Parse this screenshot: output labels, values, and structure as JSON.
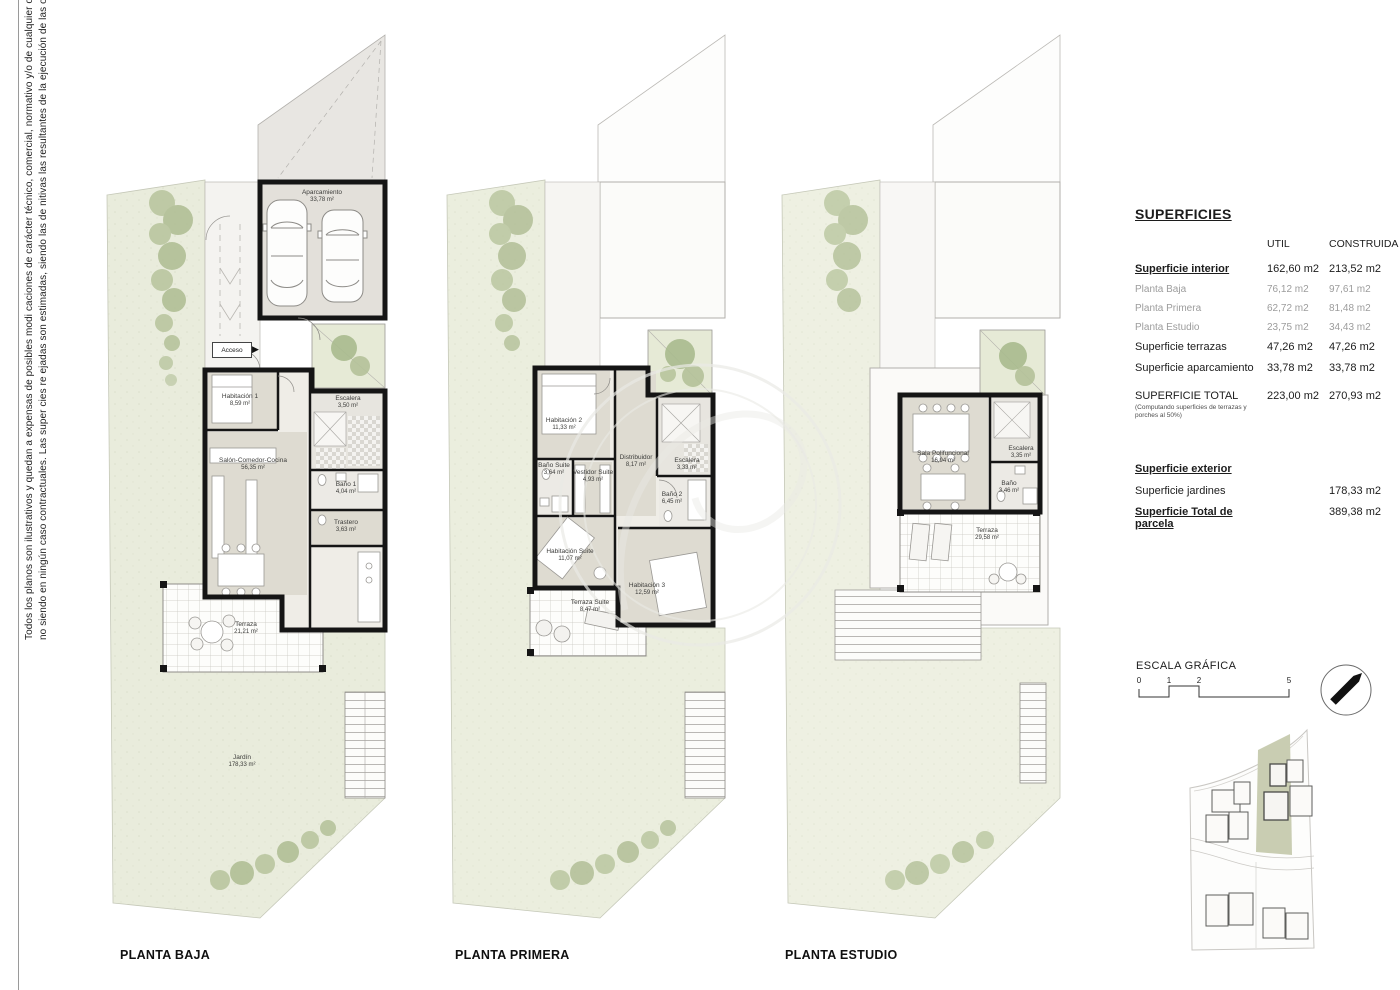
{
  "disclaimer": {
    "line1": "Todos los planos son ilustrativos y quedan a expensas de posibles modi caciones de carácter técnico, comercial, normativo y/o de cualquier otra tipología,",
    "line2": "no siendo en ningún caso contractuales. Las super cies re ejadas son estimadas, siendo las de nitivas las resultantes de la ejecución de las obras."
  },
  "icons": {
    "acceso_arrow": "▶"
  },
  "plans": {
    "baja": {
      "label": "PLANTA BAJA",
      "rooms": [
        {
          "name": "Aparcamiento",
          "area": "33,78 m²"
        },
        {
          "name": "Acceso",
          "area": ""
        },
        {
          "name": "Habitación 1",
          "area": "8,59 m²"
        },
        {
          "name": "Escalera",
          "area": "3,50 m²"
        },
        {
          "name": "Salón-Comedor-Cocina",
          "area": "56,35 m²"
        },
        {
          "name": "Baño 1",
          "area": "4,04 m²"
        },
        {
          "name": "Trastero",
          "area": "3,63 m²"
        },
        {
          "name": "Terraza",
          "area": "21,21 m²"
        },
        {
          "name": "Jardín",
          "area": "178,33 m²"
        }
      ]
    },
    "primera": {
      "label": "PLANTA PRIMERA",
      "rooms": [
        {
          "name": "Habitación 2",
          "area": "11,33 m²"
        },
        {
          "name": "Baño Suite",
          "area": "3,64 m²"
        },
        {
          "name": "Vestidor Suite",
          "area": "4,93 m²"
        },
        {
          "name": "Distribuidor",
          "area": "8,17 m²"
        },
        {
          "name": "Escalera",
          "area": "3,33 m²"
        },
        {
          "name": "Baño 2",
          "area": "6,45 m²"
        },
        {
          "name": "Habitación Suite",
          "area": "11,07 m²"
        },
        {
          "name": "Terraza Suite",
          "area": "8,47 m²"
        },
        {
          "name": "Habitación 3",
          "area": "12,59 m²"
        }
      ]
    },
    "estudio": {
      "label": "PLANTA ESTUDIO",
      "rooms": [
        {
          "name": "Sala Polifuncional",
          "area": "16,94 m²"
        },
        {
          "name": "Escalera",
          "area": "3,35 m²"
        },
        {
          "name": "Baño",
          "area": "3,46 m²"
        },
        {
          "name": "Terraza",
          "area": "29,58 m²"
        }
      ]
    }
  },
  "superficies": {
    "title": "SUPERFICIES",
    "columns": {
      "util": "UTIL",
      "construida": "CONSTRUIDA"
    },
    "interior": {
      "label": "Superficie interior",
      "util": "162,60 m2",
      "construida": "213,52 m2"
    },
    "plantas": [
      {
        "label": "Planta Baja",
        "util": "76,12 m2",
        "construida": "97,61 m2"
      },
      {
        "label": "Planta Primera",
        "util": "62,72 m2",
        "construida": "81,48 m2"
      },
      {
        "label": "Planta Estudio",
        "util": "23,75 m2",
        "construida": "34,43 m2"
      }
    ],
    "terrazas": {
      "label": "Superficie terrazas",
      "util": "47,26 m2",
      "construida": "47,26 m2"
    },
    "aparcamiento": {
      "label": "Superficie aparcamiento",
      "util": "33,78 m2",
      "construida": "33,78 m2"
    },
    "total": {
      "label": "SUPERFICIE TOTAL",
      "note": "(Computando superficies de terrazas y porches al 50%)",
      "util": "223,00 m2",
      "construida": "270,93 m2"
    },
    "exterior": {
      "label": "Superficie exterior"
    },
    "jardines": {
      "label": "Superficie jardines",
      "construida": "178,33 m2"
    },
    "parcela": {
      "label": "Superficie Total de parcela",
      "construida": "389,38 m2"
    }
  },
  "escala": {
    "title": "ESCALA GRÁFICA",
    "ticks": [
      "0",
      "1",
      "2",
      "5"
    ]
  },
  "colors": {
    "garden": "#e9ecdc",
    "tree": "#b7c49c",
    "wall": "#151515",
    "room_floor": "#dedbd1",
    "highlight_parcel": "#c9cdb2"
  }
}
